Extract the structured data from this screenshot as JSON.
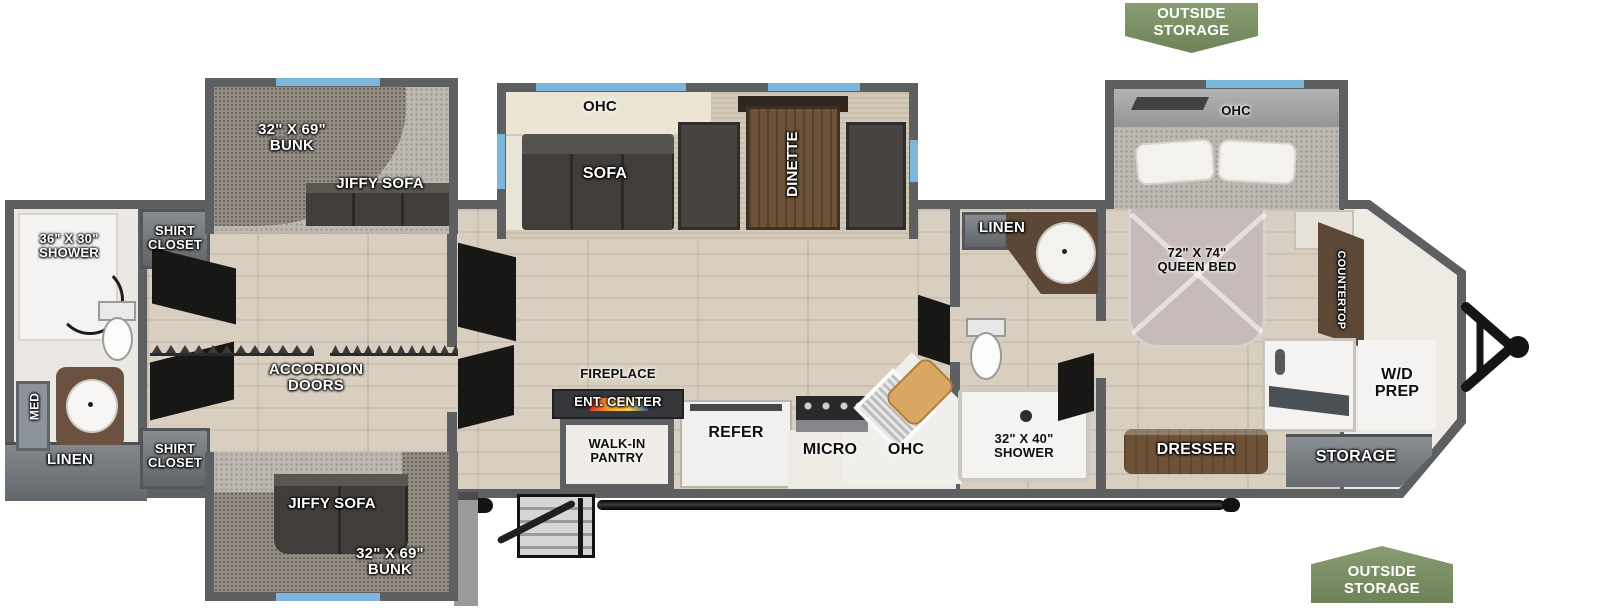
{
  "colors": {
    "wall": "#5d5f61",
    "floor": "#d8cfc0",
    "slide-floor": "#d3c9b8",
    "carpet": "#bdb8b1",
    "pad": "#948e85",
    "cushion": "#413d3a",
    "wood": "#6e5238",
    "bed": "#c7bbb9",
    "window": "#7db6db",
    "badge": "#7a9162",
    "cabinet": "#6e7378",
    "white-fixture": "#f4f3f1"
  },
  "badges": {
    "top_right": "OUTSIDE\nSTORAGE",
    "bottom_right": "OUTSIDE\nSTORAGE"
  },
  "rear_bath": {
    "shower": "36\" X 30\"\nSHOWER",
    "med": "MED",
    "linen": "LINEN"
  },
  "wardrobe_hall": {
    "shirt_closet_top": "SHIRT\nCLOSET",
    "shirt_closet_bottom": "SHIRT\nCLOSET",
    "accordion_doors": "ACCORDION\nDOORS"
  },
  "bunk_room_top": {
    "bunk_size": "32\" X 69\"\nBUNK",
    "jiffy_sofa": "JIFFY SOFA"
  },
  "bunk_room_bottom": {
    "jiffy_sofa": "JIFFY SOFA",
    "bunk_size": "32\" X 69\"\nBUNK"
  },
  "living_slide": {
    "ohc": "OHC",
    "sofa": "SOFA",
    "dinette": "DINETTE"
  },
  "kitchen": {
    "fireplace": "FIREPLACE",
    "ent_center": "ENT. CENTER",
    "walk_in_pantry": "WALK-IN\nPANTRY",
    "refer": "REFER",
    "micro": "MICRO",
    "ohc": "OHC"
  },
  "mid_bath": {
    "linen": "LINEN",
    "shower": "32\" X 40\"\nSHOWER"
  },
  "bedroom": {
    "ohc": "OHC",
    "queen_bed": "72\" X 74\"\nQUEEN BED",
    "countertop": "COUNTERTOP",
    "dresser": "DRESSER",
    "wd_prep": "W/D\nPREP",
    "storage": "STORAGE"
  }
}
